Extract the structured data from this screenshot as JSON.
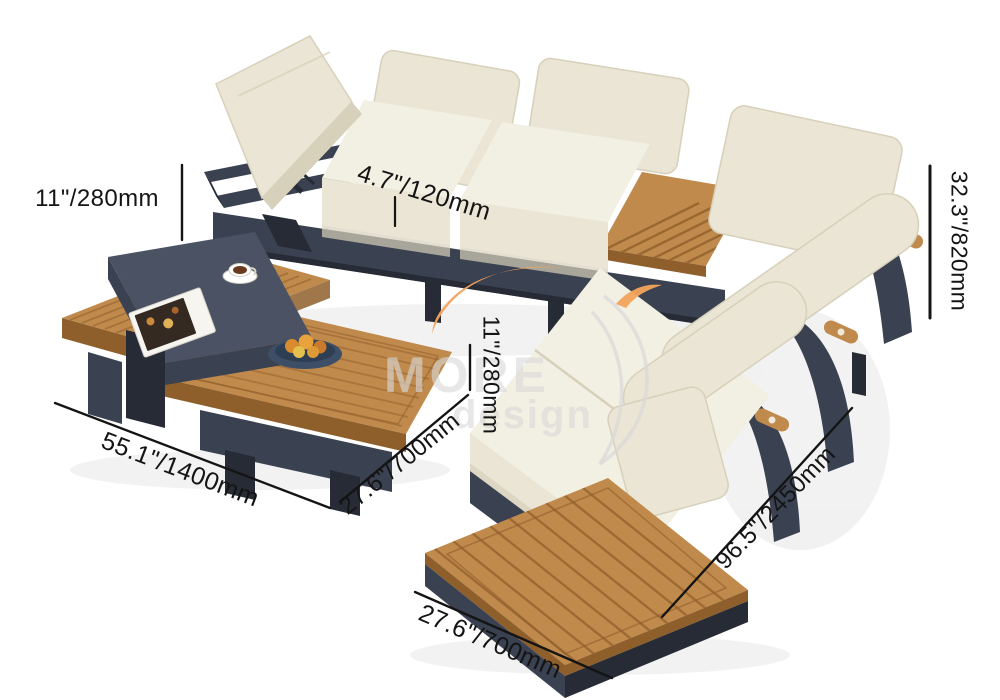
{
  "annotations": {
    "backrest_height": "11\"/280mm",
    "cushion_thickness": "4.7\"/120mm",
    "overall_height": "32.3\"/820mm",
    "seat_height": "11\"/280mm",
    "coffee_table_length": "55.1\"/1400mm",
    "coffee_table_width": "27.6\"/700mm",
    "sofa_length": "96.5\"/2450mm",
    "sofa_depth": "27.6\"/700mm"
  },
  "watermark": {
    "brand_top": "MORE",
    "brand_bottom": "design"
  },
  "colors": {
    "background": "#FFFFFF",
    "frame_dark": "#3A4150",
    "frame_mid": "#4A5263",
    "frame_darker": "#262B35",
    "cushion": "#EAE5D4",
    "cushion_light": "#F2EFE3",
    "cushion_shade": "#D7D0BA",
    "wood": "#C18A4D",
    "wood_dark": "#8F5F2B",
    "wood_side": "#A4743A",
    "accent_orange": "#F2A35B",
    "watermark_gray": "#D9D9D9",
    "line": "#141414",
    "text": "#141414",
    "plate_blue": "#3D4F66",
    "coffee": "#6B3A1E"
  }
}
